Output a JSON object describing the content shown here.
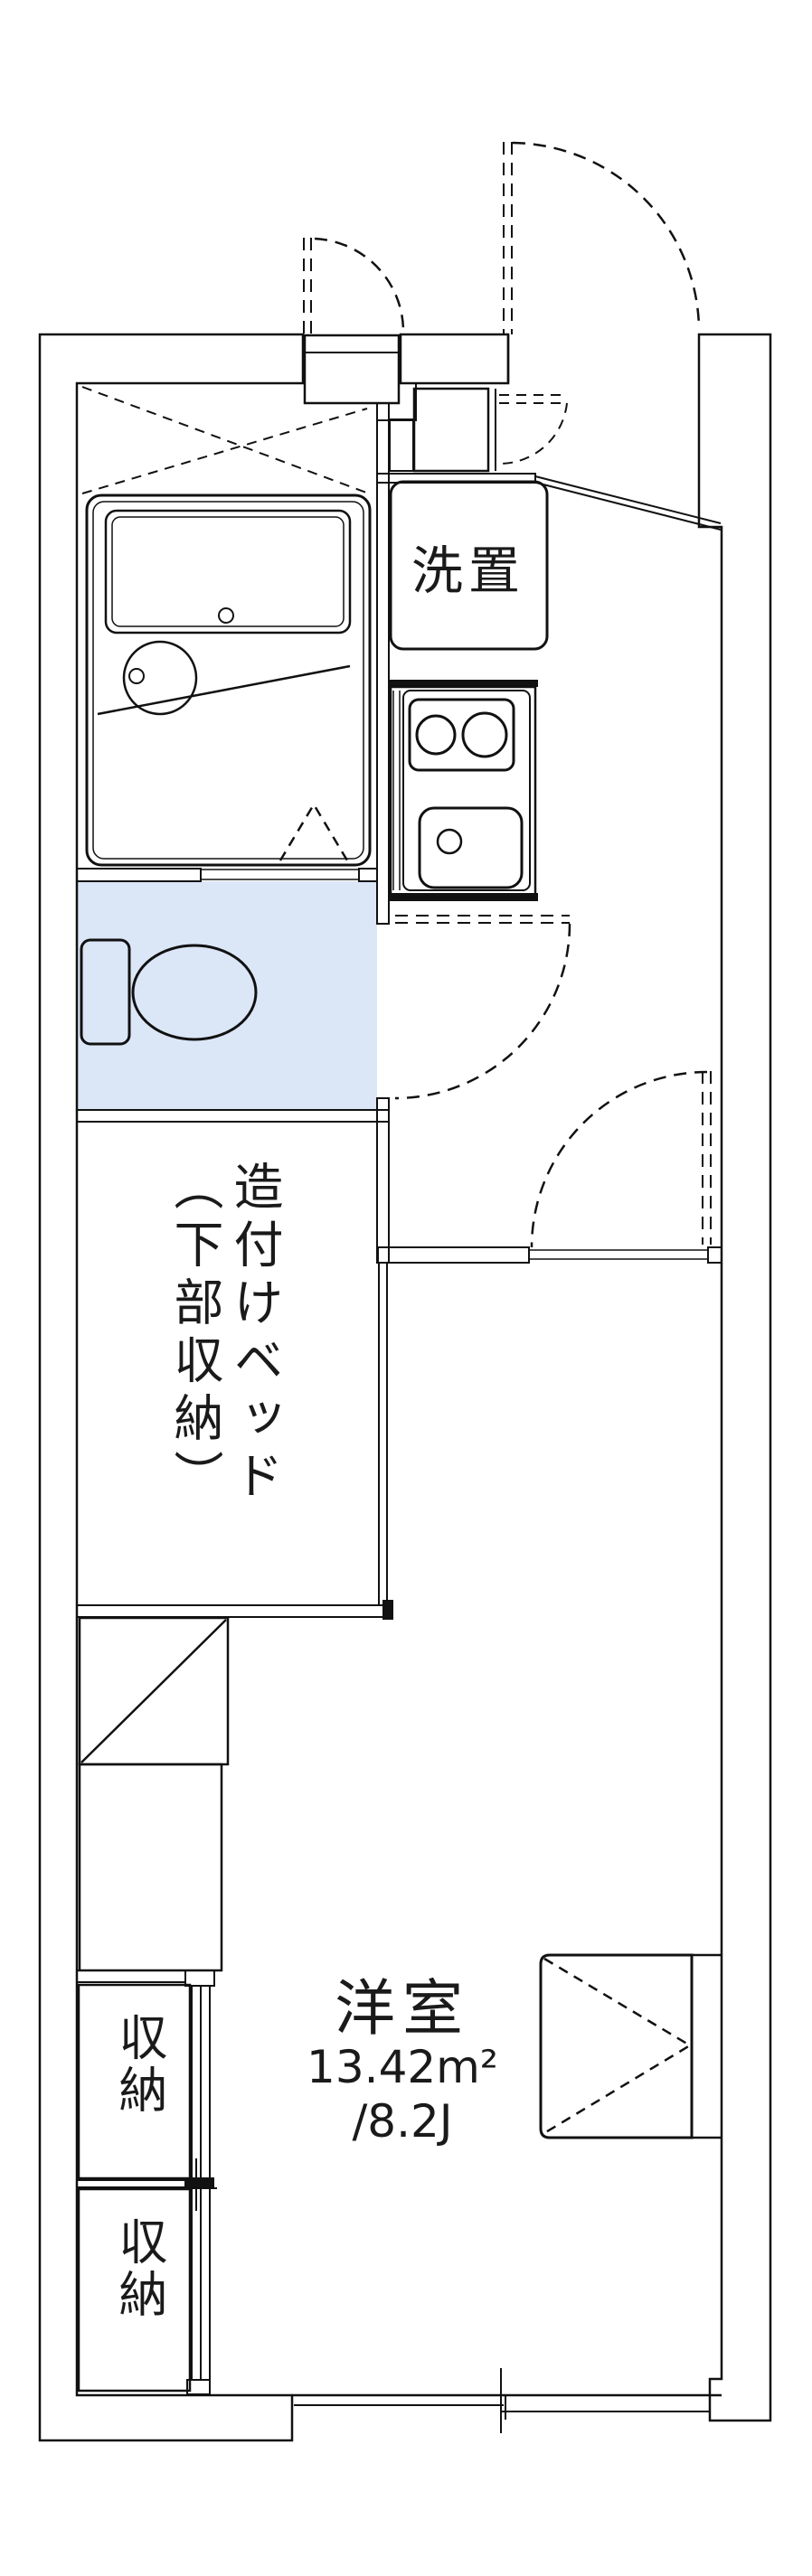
{
  "title": "apartment-floorplan",
  "labels": {
    "washer_place": "洗置",
    "built_in_bed": "造付けベッド（下部収納）",
    "storage_upper": "収納",
    "storage_lower": "収納",
    "room_name": "洋室",
    "room_area_m2": "13.42m²",
    "room_area_tatami": "/8.2J"
  },
  "colors": {
    "wall": "#8a8a8a",
    "water": "#dbe6f7",
    "water_light": "#e7eefb",
    "stove_panel": "#f6f9ff",
    "storage": "#fbf0d9",
    "line": "#111111",
    "background": "#ffffff"
  }
}
